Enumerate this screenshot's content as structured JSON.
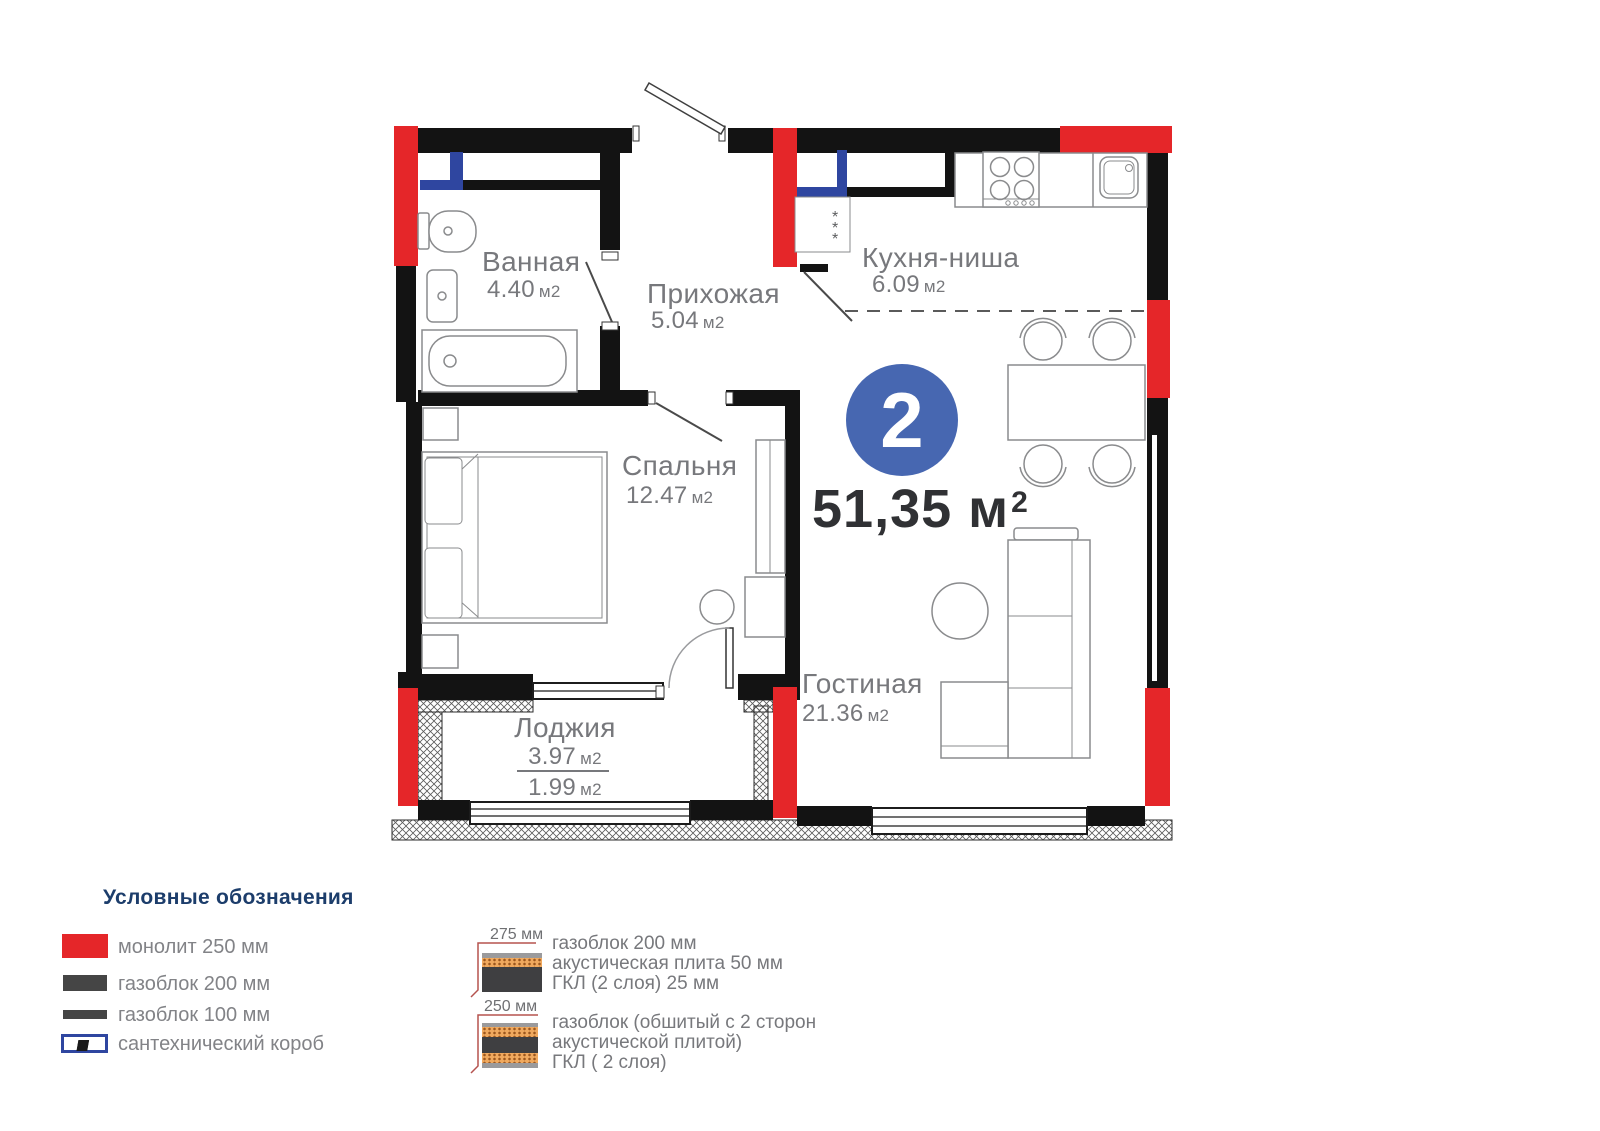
{
  "plan": {
    "badge": "2",
    "total_area": "51,35",
    "total_area_unit": "м",
    "total_area_exp": "2",
    "rooms": [
      {
        "name": "Ванная",
        "area": "4.40",
        "unit": "м2"
      },
      {
        "name": "Прихожая",
        "area": "5.04",
        "unit": "м2"
      },
      {
        "name": "Кухня-ниша",
        "area": "6.09",
        "unit": "м2"
      },
      {
        "name": "Спальня",
        "area": "12.47",
        "unit": "м2"
      },
      {
        "name": "Гостиная",
        "area": "21.36",
        "unit": "м2"
      },
      {
        "name": "Лоджия",
        "area": "3.97",
        "unit": "м2",
        "area_reduced": "1.99",
        "unit_reduced": "м2"
      }
    ],
    "fridge_mark": "*"
  },
  "legend": {
    "title": "Условные обозначения",
    "items": [
      {
        "label": "монолит 250 мм"
      },
      {
        "label": "газоблок 200 мм"
      },
      {
        "label": "газоблок 100 мм"
      },
      {
        "label": "сантехнический короб"
      }
    ]
  },
  "wall_details": [
    {
      "dimension": "275 мм",
      "line1": "газоблок 200 мм",
      "line2": "акустическая плита 50 мм",
      "line3": "ГКЛ (2 слоя) 25 мм"
    },
    {
      "dimension": "250 мм",
      "line1": "газоблок (обшитый с 2 сторон",
      "line2": "акустической плитой)",
      "line3": "ГКЛ ( 2 слоя)"
    }
  ],
  "colors": {
    "monolith_red": "#e52629",
    "gasblock_dark": "#454545",
    "sanitary_blue": "#2f46a0",
    "badge_blue": "#4767b1",
    "legend_heading": "#1c3d6b",
    "label_gray": "#77787c",
    "acoustic_orange": "#f0a95e"
  }
}
